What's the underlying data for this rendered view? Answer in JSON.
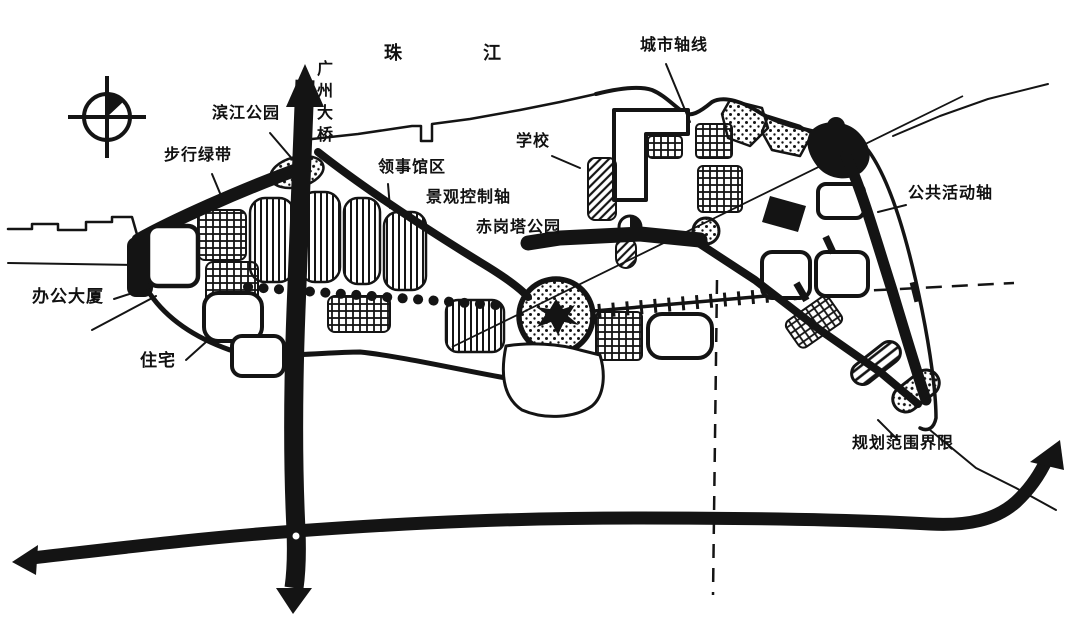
{
  "page": {
    "background": "#ffffff",
    "ink": "#141414"
  },
  "map": {
    "type": "urban-planning-sketch-diagram",
    "compass": "north-compass",
    "labels": [
      {
        "id": "pearl-river",
        "text": "珠 江"
      },
      {
        "id": "guangzhou-bridge",
        "text": "广州大桥"
      },
      {
        "id": "binjiang-park",
        "text": "滨江公园"
      },
      {
        "id": "pedestrian-green-belt",
        "text": "步行绿带"
      },
      {
        "id": "consulate-district",
        "text": "领事馆区"
      },
      {
        "id": "landscape-control-axis",
        "text": "景观控制轴"
      },
      {
        "id": "chigang-pagoda-park",
        "text": "赤岗塔公园"
      },
      {
        "id": "school",
        "text": "学校"
      },
      {
        "id": "city-axis",
        "text": "城市轴线"
      },
      {
        "id": "public-activity-axis",
        "text": "公共活动轴"
      },
      {
        "id": "office-building",
        "text": "办公大厦"
      },
      {
        "id": "residence",
        "text": "住宅"
      },
      {
        "id": "planning-boundary",
        "text": "规划范围界限"
      }
    ]
  }
}
